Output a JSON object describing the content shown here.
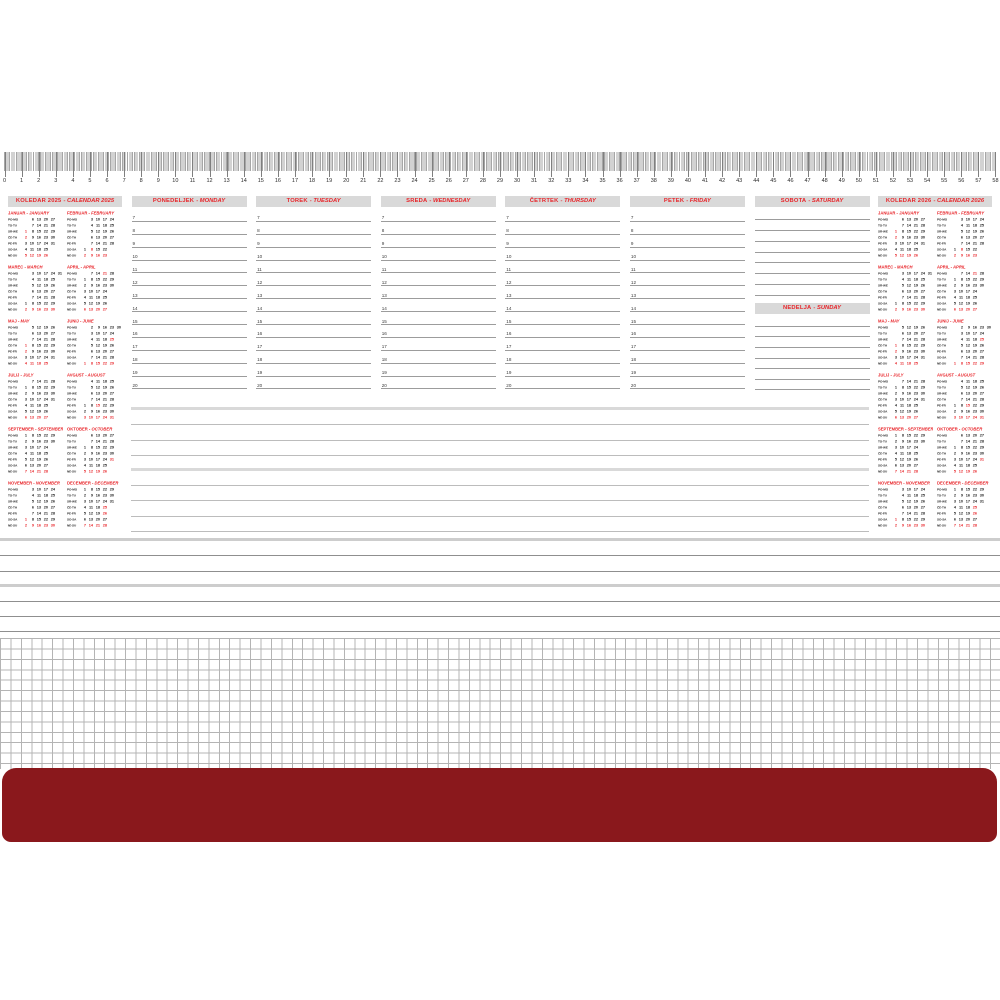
{
  "colors": {
    "accent_red": "#e8252a",
    "header_bar_bg": "#d9d9d9",
    "bottom_bar_red": "#8a181c",
    "grid_line": "#b4b4b4",
    "rule_line": "#9c9c9c"
  },
  "ruler": {
    "unit": "cm",
    "start": 0,
    "end": 58
  },
  "calendars": {
    "left": {
      "title_sl": "KOLEDAR 2025",
      "title_en": "CALENDAR 2025"
    },
    "right": {
      "title_sl": "KOLEDAR 2026",
      "title_en": "CALENDAR 2026"
    }
  },
  "day_row_labels": [
    "PO-MO",
    "TO-TU",
    "SR-WE",
    "ČE-TH",
    "PE-FR",
    "SO-SA",
    "NE-SU"
  ],
  "months": [
    {
      "sl": "JANUAR",
      "en": "JANUARY",
      "red": [
        1,
        2
      ],
      "rows": [
        [
          "",
          6,
          13,
          20,
          27,
          ""
        ],
        [
          "",
          7,
          14,
          21,
          28,
          ""
        ],
        [
          1,
          8,
          15,
          22,
          29,
          ""
        ],
        [
          2,
          9,
          16,
          23,
          30,
          ""
        ],
        [
          3,
          10,
          17,
          24,
          31,
          ""
        ],
        [
          4,
          11,
          18,
          25,
          "",
          ""
        ],
        [
          5,
          12,
          19,
          26,
          "",
          ""
        ]
      ]
    },
    {
      "sl": "FEBRUAR",
      "en": "FEBRUARY",
      "red": [
        8
      ],
      "rows": [
        [
          "",
          3,
          10,
          17,
          24,
          ""
        ],
        [
          "",
          4,
          11,
          18,
          25,
          ""
        ],
        [
          "",
          5,
          12,
          19,
          26,
          ""
        ],
        [
          "",
          6,
          13,
          20,
          27,
          ""
        ],
        [
          "",
          7,
          14,
          21,
          28,
          ""
        ],
        [
          1,
          8,
          15,
          22,
          "",
          ""
        ],
        [
          2,
          9,
          16,
          23,
          "",
          ""
        ]
      ]
    },
    {
      "sl": "MAREC",
      "en": "MARCH",
      "red": [],
      "rows": [
        [
          "",
          3,
          10,
          17,
          24,
          31
        ],
        [
          "",
          4,
          11,
          18,
          25,
          ""
        ],
        [
          "",
          5,
          12,
          19,
          26,
          ""
        ],
        [
          "",
          6,
          13,
          20,
          27,
          ""
        ],
        [
          "",
          7,
          14,
          21,
          28,
          ""
        ],
        [
          1,
          8,
          15,
          22,
          29,
          ""
        ],
        [
          2,
          9,
          16,
          23,
          30,
          ""
        ]
      ]
    },
    {
      "sl": "APRIL",
      "en": "APRIL",
      "red": [
        21
      ],
      "rows": [
        [
          "",
          7,
          14,
          21,
          28,
          ""
        ],
        [
          1,
          8,
          15,
          22,
          29,
          ""
        ],
        [
          2,
          9,
          16,
          23,
          30,
          ""
        ],
        [
          3,
          10,
          17,
          24,
          "",
          ""
        ],
        [
          4,
          11,
          18,
          25,
          "",
          ""
        ],
        [
          5,
          12,
          19,
          26,
          "",
          ""
        ],
        [
          6,
          13,
          20,
          27,
          "",
          ""
        ]
      ]
    },
    {
      "sl": "MAJ",
      "en": "MAY",
      "red": [
        1,
        2
      ],
      "rows": [
        [
          "",
          5,
          12,
          19,
          26,
          ""
        ],
        [
          "",
          6,
          13,
          20,
          27,
          ""
        ],
        [
          "",
          7,
          14,
          21,
          28,
          ""
        ],
        [
          1,
          8,
          15,
          22,
          29,
          ""
        ],
        [
          2,
          9,
          16,
          23,
          30,
          ""
        ],
        [
          3,
          10,
          17,
          24,
          31,
          ""
        ],
        [
          4,
          11,
          18,
          25,
          "",
          ""
        ]
      ]
    },
    {
      "sl": "JUNIJ",
      "en": "JUNE",
      "red": [
        25
      ],
      "rows": [
        [
          "",
          2,
          9,
          16,
          23,
          30
        ],
        [
          "",
          3,
          10,
          17,
          24,
          ""
        ],
        [
          "",
          4,
          11,
          18,
          25,
          ""
        ],
        [
          "",
          5,
          12,
          19,
          26,
          ""
        ],
        [
          "",
          6,
          13,
          20,
          27,
          ""
        ],
        [
          "",
          7,
          14,
          21,
          28,
          ""
        ],
        [
          1,
          8,
          15,
          22,
          29,
          ""
        ]
      ]
    },
    {
      "sl": "JULIJ",
      "en": "JULY",
      "red": [],
      "rows": [
        [
          "",
          7,
          14,
          21,
          28,
          ""
        ],
        [
          1,
          8,
          15,
          22,
          29,
          ""
        ],
        [
          2,
          9,
          16,
          23,
          30,
          ""
        ],
        [
          3,
          10,
          17,
          24,
          31,
          ""
        ],
        [
          4,
          11,
          18,
          25,
          "",
          ""
        ],
        [
          5,
          12,
          19,
          26,
          "",
          ""
        ],
        [
          6,
          13,
          20,
          27,
          "",
          ""
        ]
      ]
    },
    {
      "sl": "AVGUST",
      "en": "AUGUST",
      "red": [
        15
      ],
      "rows": [
        [
          "",
          4,
          11,
          18,
          25,
          ""
        ],
        [
          "",
          5,
          12,
          19,
          26,
          ""
        ],
        [
          "",
          6,
          13,
          20,
          27,
          ""
        ],
        [
          "",
          7,
          14,
          21,
          28,
          ""
        ],
        [
          1,
          8,
          15,
          22,
          29,
          ""
        ],
        [
          2,
          9,
          16,
          23,
          30,
          ""
        ],
        [
          3,
          10,
          17,
          24,
          31,
          ""
        ]
      ]
    },
    {
      "sl": "SEPTEMBER",
      "en": "SEPTEMBER",
      "red": [],
      "rows": [
        [
          1,
          8,
          15,
          22,
          29,
          ""
        ],
        [
          2,
          9,
          16,
          23,
          30,
          ""
        ],
        [
          3,
          10,
          17,
          24,
          "",
          ""
        ],
        [
          4,
          11,
          18,
          25,
          "",
          ""
        ],
        [
          5,
          12,
          19,
          26,
          "",
          ""
        ],
        [
          6,
          13,
          20,
          27,
          "",
          ""
        ],
        [
          7,
          14,
          21,
          28,
          "",
          ""
        ]
      ]
    },
    {
      "sl": "OKTOBER",
      "en": "OCTOBER",
      "red": [
        31
      ],
      "rows": [
        [
          "",
          6,
          13,
          20,
          27,
          ""
        ],
        [
          "",
          7,
          14,
          21,
          28,
          ""
        ],
        [
          1,
          8,
          15,
          22,
          29,
          ""
        ],
        [
          2,
          9,
          16,
          23,
          30,
          ""
        ],
        [
          3,
          10,
          17,
          24,
          31,
          ""
        ],
        [
          4,
          11,
          18,
          25,
          "",
          ""
        ],
        [
          5,
          12,
          19,
          26,
          "",
          ""
        ]
      ]
    },
    {
      "sl": "NOVEMBER",
      "en": "NOVEMBER",
      "red": [
        1
      ],
      "rows": [
        [
          "",
          3,
          10,
          17,
          24,
          ""
        ],
        [
          "",
          4,
          11,
          18,
          25,
          ""
        ],
        [
          "",
          5,
          12,
          19,
          26,
          ""
        ],
        [
          "",
          6,
          13,
          20,
          27,
          ""
        ],
        [
          "",
          7,
          14,
          21,
          28,
          ""
        ],
        [
          1,
          8,
          15,
          22,
          29,
          ""
        ],
        [
          2,
          9,
          16,
          23,
          30,
          ""
        ]
      ]
    },
    {
      "sl": "DECEMBER",
      "en": "DECEMBER",
      "red": [
        25,
        26
      ],
      "rows": [
        [
          1,
          8,
          15,
          22,
          29,
          ""
        ],
        [
          2,
          9,
          16,
          23,
          30,
          ""
        ],
        [
          3,
          10,
          17,
          24,
          31,
          ""
        ],
        [
          4,
          11,
          18,
          25,
          "",
          ""
        ],
        [
          5,
          12,
          19,
          26,
          "",
          ""
        ],
        [
          6,
          13,
          20,
          27,
          "",
          ""
        ],
        [
          7,
          14,
          21,
          28,
          "",
          ""
        ]
      ]
    }
  ],
  "weekdays": [
    {
      "sl": "PONEDELJEK",
      "en": "MONDAY"
    },
    {
      "sl": "TOREK",
      "en": "TUESDAY"
    },
    {
      "sl": "SREDA",
      "en": "WEDNESDAY"
    },
    {
      "sl": "ČETRTEK",
      "en": "THURSDAY"
    },
    {
      "sl": "PETEK",
      "en": "FRIDAY"
    }
  ],
  "weekend": {
    "saturday": {
      "sl": "SOBOTA",
      "en": "SATURDAY"
    },
    "sunday": {
      "sl": "NEDELJA",
      "en": "SUNDAY"
    }
  },
  "hours": [
    7,
    8,
    9,
    10,
    11,
    12,
    13,
    14,
    15,
    16,
    17,
    18,
    19,
    20
  ]
}
